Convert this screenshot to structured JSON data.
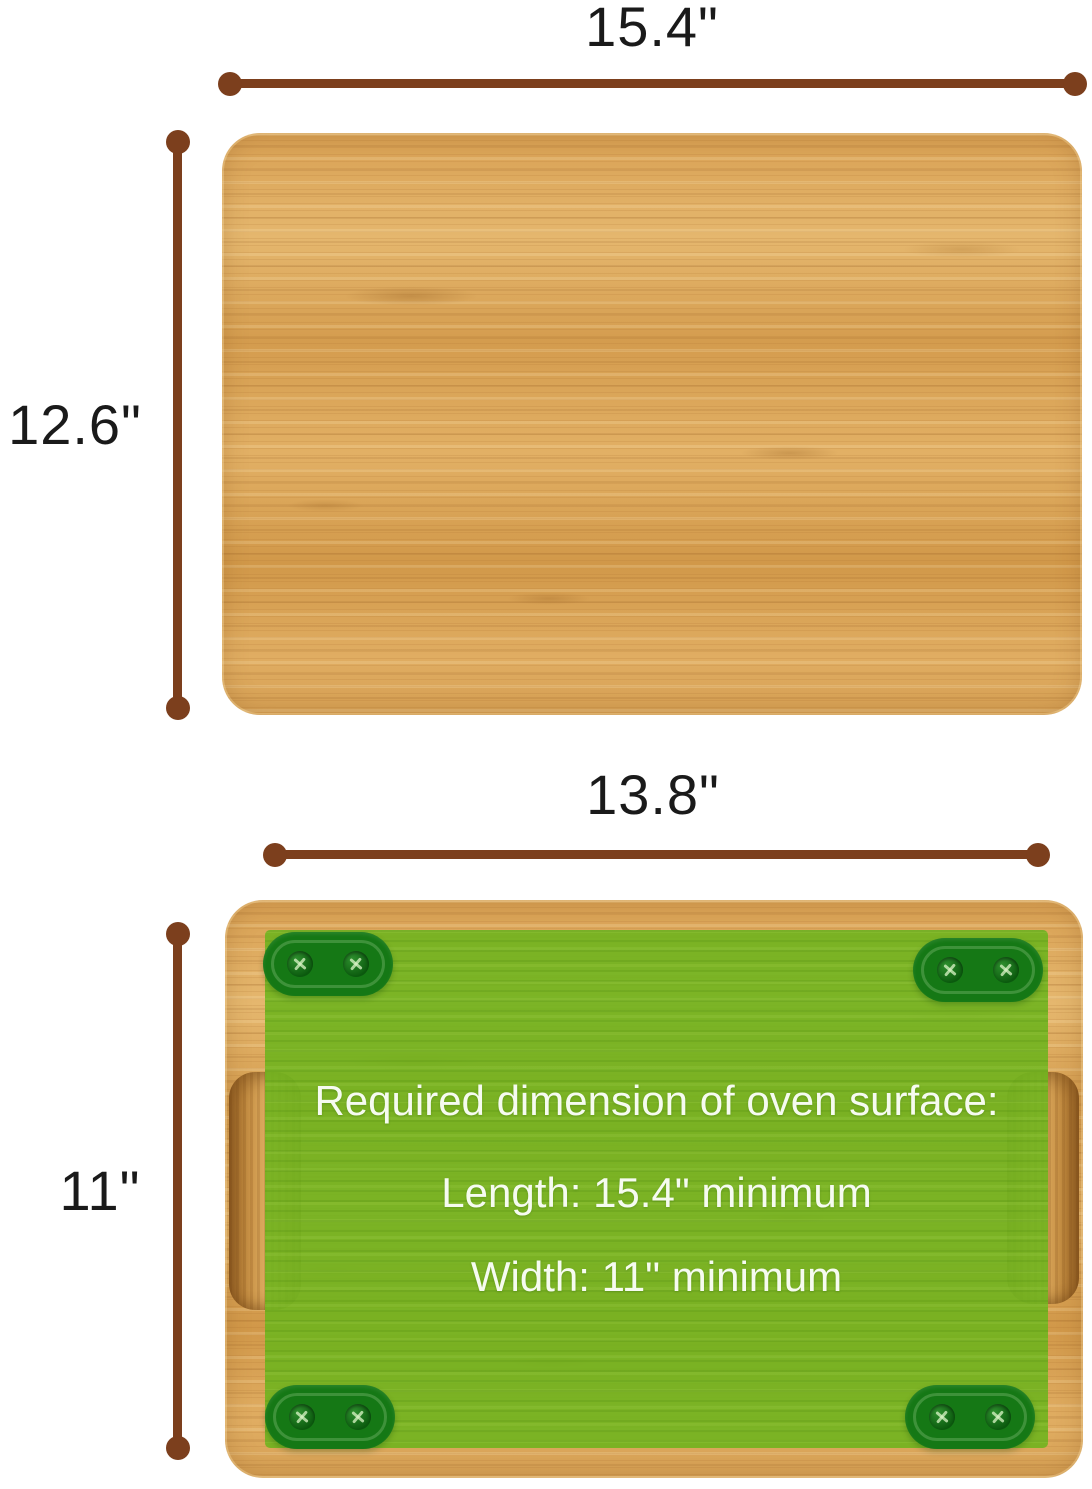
{
  "colors": {
    "background": "#ffffff",
    "dimension_line": "#7c3f1d",
    "label_text": "#1a1a1a",
    "overlay_green": "#76b52f",
    "foot_green": "#157815",
    "overlay_text": "#f6fbf0",
    "wood_base": "#d9a458"
  },
  "top_view": {
    "width_label": "15.4\"",
    "height_label": "12.6\""
  },
  "bottom_view": {
    "width_label": "13.8\"",
    "height_label": "11\"",
    "overlay": {
      "title": "Required dimension of oven surface:",
      "length_text": "Length: 15.4\" minimum",
      "width_text": "Width: 11\" minimum"
    }
  }
}
